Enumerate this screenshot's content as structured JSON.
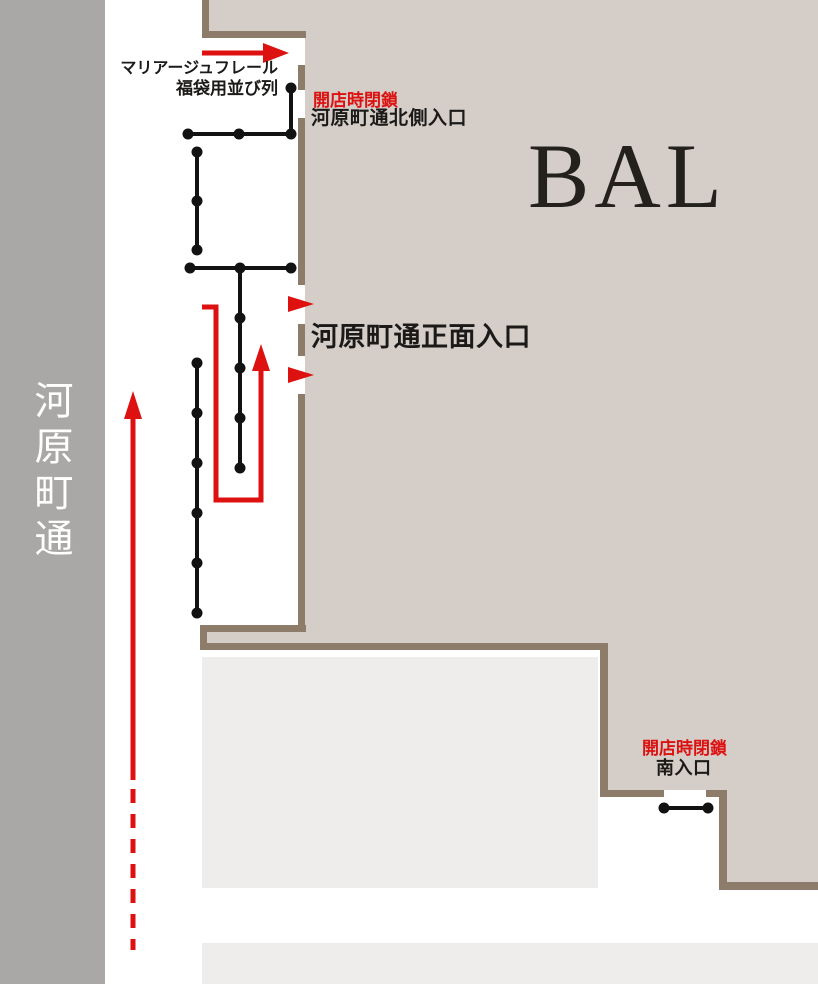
{
  "canvas": {
    "width": 818,
    "height": 984
  },
  "street": {
    "name": "河原町通"
  },
  "building": {
    "name": "BAL"
  },
  "queue": {
    "label_line1": "マリアージュフレール",
    "label_line2": "福袋用並び列"
  },
  "entrances": {
    "north": {
      "status": "開店時閉鎖",
      "label": "河原町通北側入口"
    },
    "main": {
      "label": "河原町通正面入口"
    },
    "south": {
      "status": "開店時閉鎖",
      "label": "南入口"
    }
  },
  "colors": {
    "street_gray": "#a9a8a6",
    "building_beige": "#d5cec8",
    "wall_brown": "#8e7c6b",
    "neighbor_gray": "#efedeb",
    "accent_red": "#dc1110",
    "queue_black": "#121212",
    "title_black": "#24211d",
    "street_text": "#ffffff"
  }
}
